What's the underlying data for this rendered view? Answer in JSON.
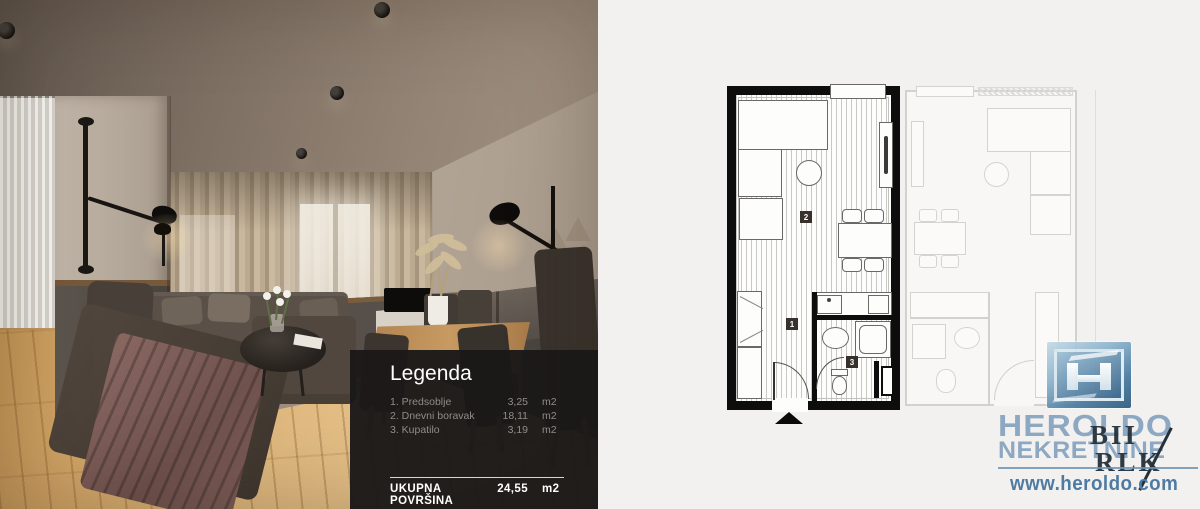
{
  "legend": {
    "title": "Legenda",
    "items": [
      {
        "label": "1. Predsoblje",
        "value": "3,25",
        "unit": "m2"
      },
      {
        "label": "2. Dnevni boravak",
        "value": "18,11",
        "unit": "m2"
      },
      {
        "label": "3. Kupatilo",
        "value": "3,19",
        "unit": "m2"
      }
    ],
    "total_label": "UKUPNA POVRŠINA",
    "total_value": "24,55",
    "total_unit": "m2"
  },
  "floorplan": {
    "markers": {
      "m1": "1",
      "m2": "2",
      "m3": "3"
    }
  },
  "watermark": {
    "brand": "HEROLDO",
    "subtitle": "NEKRETNINE",
    "url": "www.heroldo.com",
    "overlay_line1": "BII",
    "overlay_line2": "RLK"
  },
  "colors": {
    "legend_panel_bg": "#1b1918",
    "plan_wall": "#0d0d0d",
    "brand_blue": "#7b9cbb",
    "url_blue": "#4f7ba2",
    "right_background": "#f2f1ef"
  }
}
